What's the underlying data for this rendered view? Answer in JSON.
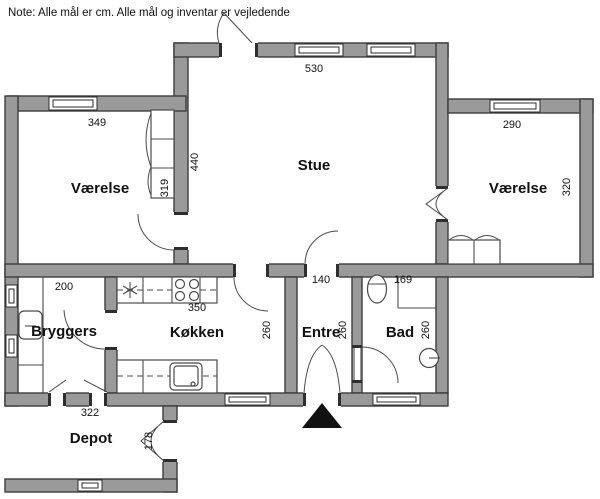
{
  "note": "Note: Alle mål er cm. Alle mål og inventar er vejledende",
  "colors": {
    "wall": "#9a9a9a",
    "wall-stroke": "#3d3d3d",
    "line": "#4a4a4a",
    "text": "#111111",
    "marker": "#111111",
    "background": "#ffffff"
  },
  "rooms": {
    "stue": {
      "name": "Stue",
      "width": "530",
      "height": "440"
    },
    "vaerelse_vest": {
      "name": "Værelse",
      "width": "349",
      "height": "319"
    },
    "vaerelse_oest": {
      "name": "Værelse",
      "width": "290",
      "height": "320"
    },
    "bryggers": {
      "name": "Bryggers",
      "width": "200"
    },
    "koekken": {
      "name": "Køkken",
      "width": "350",
      "height": "260"
    },
    "entre": {
      "name": "Entre",
      "width": "140",
      "height": "260"
    },
    "bad": {
      "name": "Bad",
      "width": "169",
      "height": "260"
    },
    "depot": {
      "name": "Depot",
      "width": "322",
      "door": "178"
    }
  },
  "symbols": {
    "entrance_marker": "black triangle at front door",
    "stove": "4 burner circles",
    "cooling": "asterisk appliance symbol",
    "sinks": [
      "bryggers sink",
      "kitchen sink",
      "bathroom basin"
    ],
    "toilet": "oval wc",
    "wardrobes": [
      "vaerelse vest closet",
      "vaerelse oest closet"
    ]
  }
}
